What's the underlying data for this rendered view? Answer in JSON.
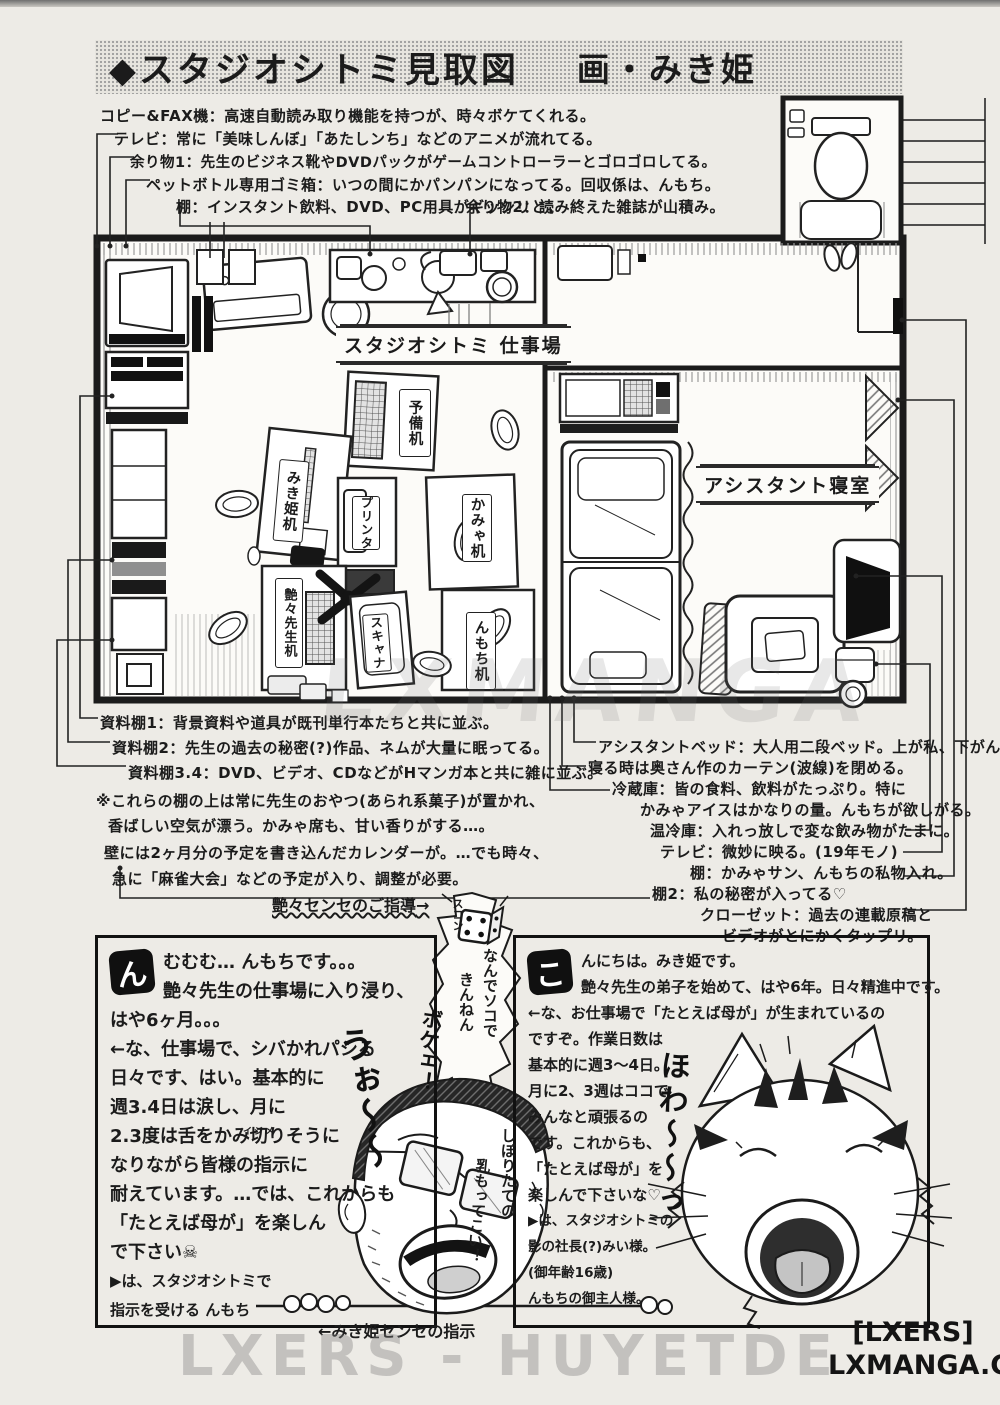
{
  "banner": {
    "title": "◆スタジオシトミ見取図",
    "author": "画・みき姫"
  },
  "top_notes": [
    "コピー&FAX機：高速自動読み取り機能を持つが、時々ボケてくれる。",
    "テレビ：常に「美味しんぼ」「あたしンち」などのアニメが流れてる。",
    "余り物1：先生のビジネス靴やDVDパックがゲームコントローラーとゴロゴロしてる。",
    "ペットボトル専用ゴミ箱：いつの間にかパンパンになってる。回収係は、んもち。",
    "棚：インスタント飲料、DVD、PC用具がギッシリと。",
    "余り物2：読み終えた雑誌が山積み。"
  ],
  "floorplan": {
    "workroom_label": "スタジオシトミ 仕事場",
    "bedroom_label": "アシスタント寝室",
    "desks": [
      "予備机",
      "みき姫机",
      "プリンタ",
      "かみゃ机",
      "艶々先生机",
      "スキャナ",
      "んもち机"
    ]
  },
  "left_notes": [
    "資料棚1：背景資料や道具が既刊単行本たちと共に並ぶ。",
    "資料棚2：先生の過去の秘密(?)作品、ネムが大量に眠ってる。",
    "資料棚3.4：DVD、ビデオ、CDなどがHマンガ本と共に雑に並ぶ。",
    "※これらの棚の上は常に先生のおやつ(あられ系菓子)が置かれ、",
    "香ばしい空気が漂う。かみゃ席も、甘い香りがする…。",
    "壁には2ヶ月分の予定を書き込んだカレンダーが。…でも時々、",
    "急に「麻雀大会」などの予定が入り、調整が必要。"
  ],
  "right_notes": [
    "アシスタントベッド：大人用二段ベッド。上が私、下がんもち。",
    "寝る時は奥さん作のカーテン(波線)を閉める。",
    "冷蔵庫：皆の食料、飲料がたっぷり。特に",
    "かみゃアイスはかなりの量。んもちが欲しがる。",
    "温冷庫：入れっ放しで変な飲み物がたまに。",
    "テレビ：微妙に映る。(19年モノ)",
    "棚：かみゃサン、んもちの私物入れ。",
    "棚2：私の秘密が入ってる♡",
    "クローゼット：過去の連載原稿と",
    "ビデオがとにかくタップリ。"
  ],
  "comic": {
    "guidance_label": "艶々センセのご指導",
    "guidance_arrow": "→",
    "bubble": {
      "sfx": "スコン",
      "line1": "なんでソコで",
      "line2": "きんねん",
      "line3": "ボケェ！"
    },
    "sfx_left": "うぉ〜〜",
    "sfx_right": "ほわ〜〜っ",
    "milk_line1": "しぼりたての",
    "milk_line2": "乳もってこい！",
    "left_panel": {
      "dropcap": "ん",
      "furigana": "イジメ",
      "lines": [
        "むむむ… んもちです。。。",
        "艶々先生の仕事場に入り浸り、",
        "はや6ヶ月。。。",
        "←な、仕事場で、シバかれパシる",
        "日々です、はい。基本的に",
        "週3.4日は涙し、月に",
        "2.3度は舌をかみ切りそうに",
        "なりながら皆様の指示に",
        "耐えています。…では、これからも",
        "「たとえば母が」を楽しん",
        "で下さい☠",
        "▶は、スタジオシトミで",
        "指示を受ける んもち"
      ]
    },
    "right_panel": {
      "dropcap": "こ",
      "lines": [
        "んにちは。みき姫です。",
        "艶々先生の弟子を始めて、はや6年。日々精進中です。",
        "←な、お仕事場で「たとえば母が」が生まれているの",
        "ですぞ。作業日数は",
        "基本的に週3〜4日。",
        "月に2、3週はココで",
        "みんなと頑張るの",
        "です。これからも、",
        "「たとえば母が」を",
        "楽しんで下さいな♡",
        "▶は、スタジオシトミの",
        "影の社長(?)みい様。",
        "(御年齢16歳)",
        "んもちの御主人様。"
      ]
    },
    "bottom_label": "←みき姫センセの指示"
  },
  "watermarks": {
    "mid": "LXMANGA",
    "bottom": "LXERS - HUYETDE",
    "tag1": "[LXERS]",
    "tag2": "LXMANGA.COM"
  }
}
